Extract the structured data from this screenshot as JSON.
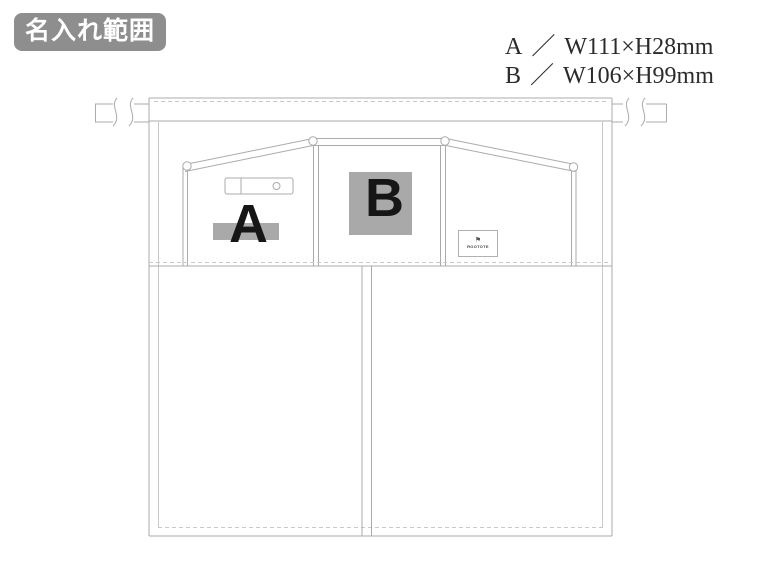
{
  "badge": {
    "label": "名入れ範囲"
  },
  "legend": {
    "separator": "／",
    "rows": [
      {
        "label": "A",
        "size": "W111×H28mm"
      },
      {
        "label": "B",
        "size": "W106×H99mm"
      }
    ]
  },
  "print_areas": [
    {
      "label": "A"
    },
    {
      "label": "B"
    }
  ],
  "brand_label": {
    "icon": "flag-icon",
    "text": "ROOTOTE"
  },
  "colors": {
    "badge_bg": "#8e8e8e",
    "badge_text": "#ffffff",
    "print_area_fill": "#a9a9a9",
    "print_letter": "#161616",
    "line": "#ababab",
    "stitch": "#c9c9c9",
    "legend_text": "#2b2b2b"
  }
}
